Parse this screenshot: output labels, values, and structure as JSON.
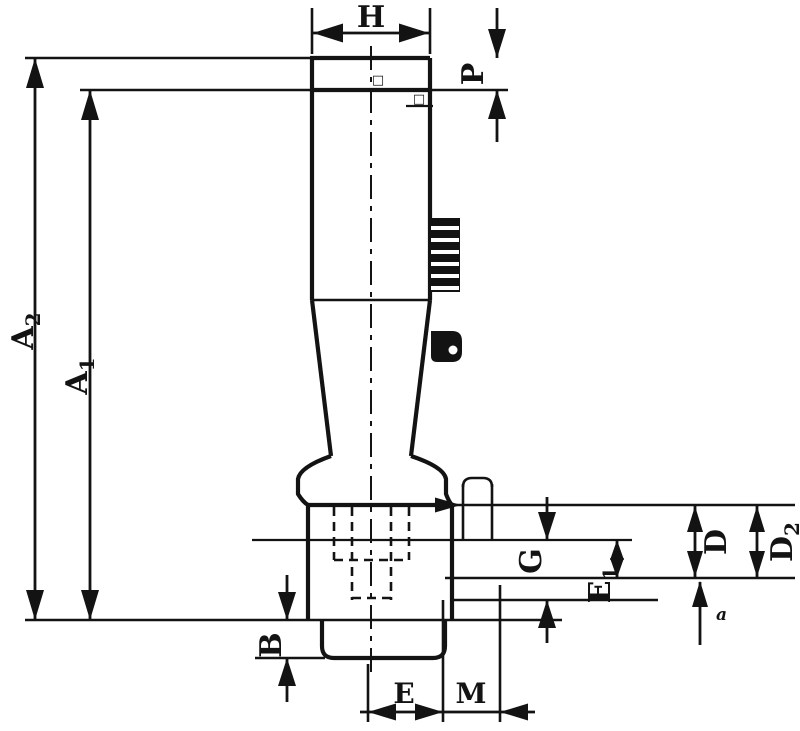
{
  "figure": {
    "type": "technical-dimension-drawing",
    "subject": "tap-extension-shank-with-square-drive",
    "colors": {
      "ink": "#131313",
      "background": "#ffffff"
    },
    "labels": {
      "h": "H",
      "p": "P",
      "a2_main": "A",
      "a2_sub": "2",
      "a1_main": "A",
      "a1_sub": "1",
      "b": "B",
      "g": "G",
      "e1_main": "E",
      "e1_sub": "1",
      "d": "D",
      "d2_main": "D",
      "d2_sub": "2",
      "e": "E",
      "m": "M",
      "a_small": "a",
      "mark_top": "□",
      "mark_bottom": "□"
    }
  }
}
